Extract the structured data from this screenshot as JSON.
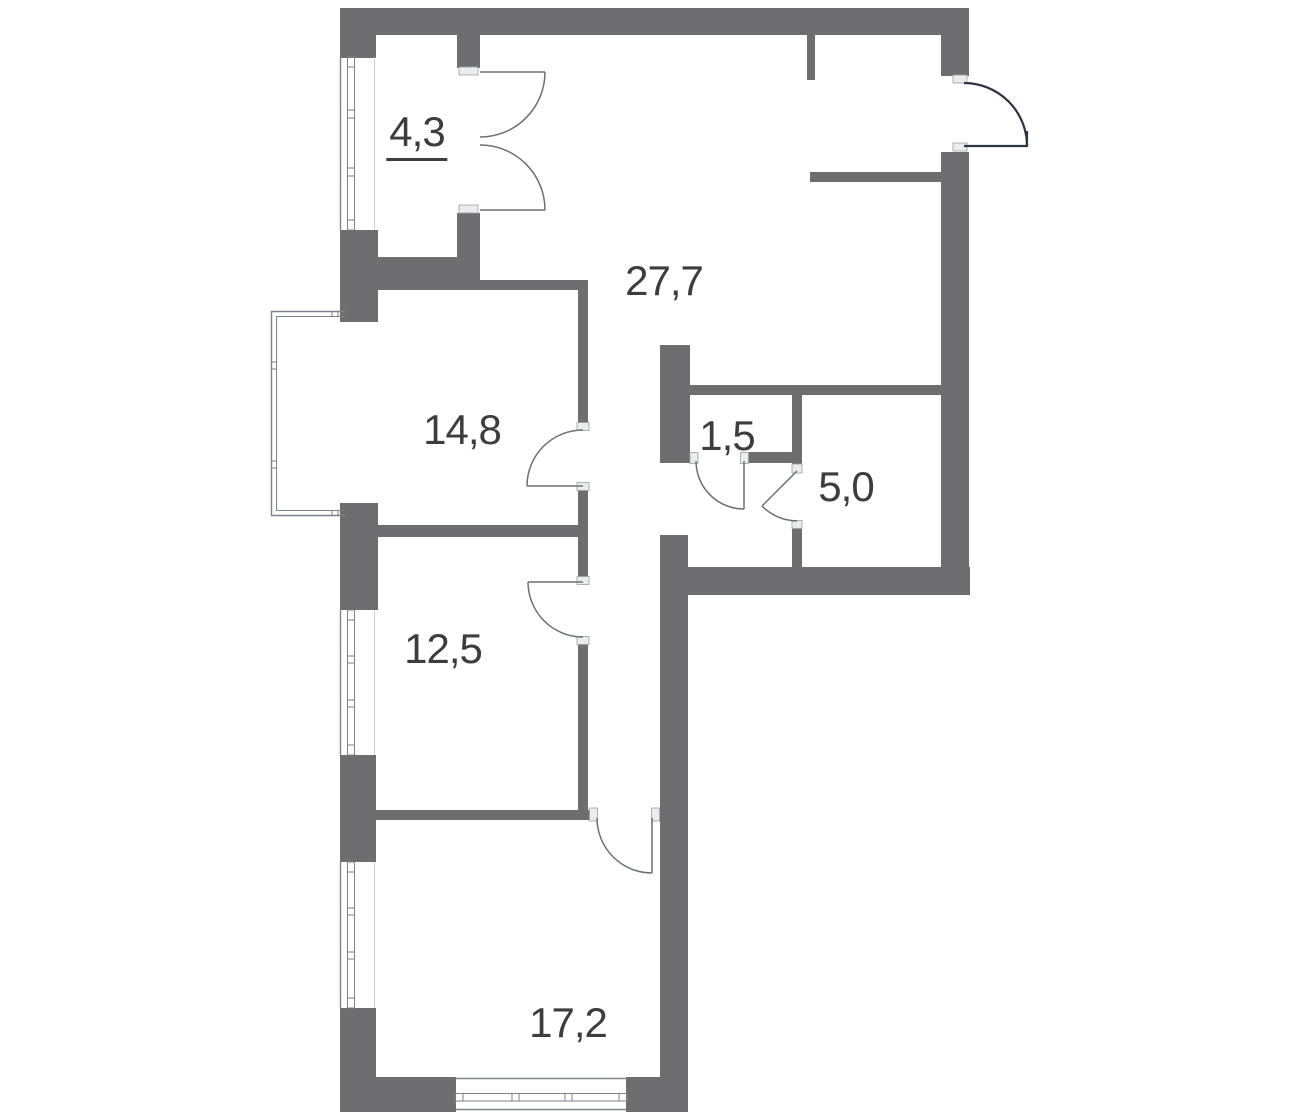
{
  "plan": {
    "type": "apartment-floor-plan",
    "canvas_width": 1300,
    "canvas_height": 1120
  },
  "rooms": [
    {
      "id": "loggia",
      "area_label": "4,3",
      "underlined": true
    },
    {
      "id": "living-kitchen",
      "area_label": "27,7",
      "underlined": false
    },
    {
      "id": "room-a",
      "area_label": "14,8",
      "underlined": false
    },
    {
      "id": "wc",
      "area_label": "1,5",
      "underlined": false
    },
    {
      "id": "bathroom",
      "area_label": "5,0",
      "underlined": false
    },
    {
      "id": "room-b",
      "area_label": "12,5",
      "underlined": false
    },
    {
      "id": "room-c",
      "area_label": "17,2",
      "underlined": false
    }
  ],
  "colors": {
    "wall": "#6e6e70",
    "background": "#ffffff",
    "label_text": "#3d3d3f",
    "door_arc": "#6b7077",
    "entrance_door": "#2b3646",
    "window_line": "#7d828c",
    "frame_fill": "#ececec",
    "frame_stroke": "#9aa0a8"
  }
}
